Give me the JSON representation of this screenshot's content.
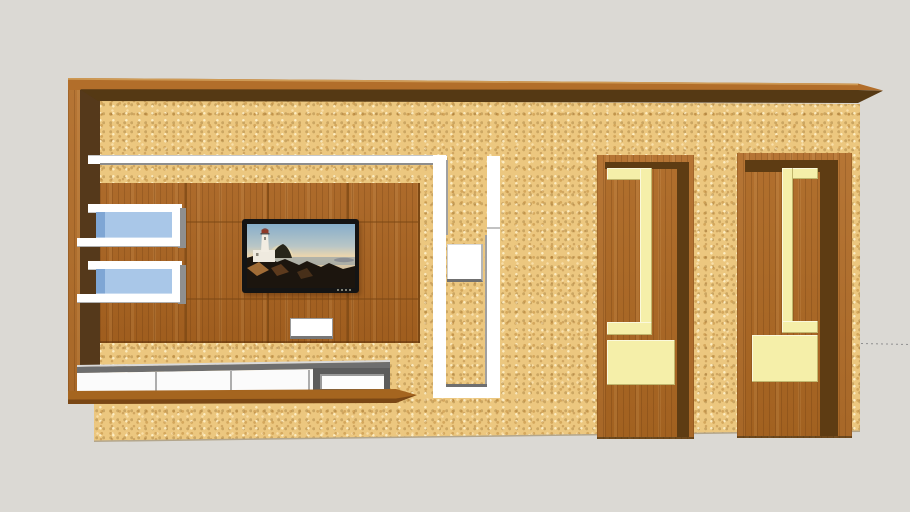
{
  "viewer": {
    "type": "3d-model-viewer",
    "canvas_width": 910,
    "canvas_height": 512
  },
  "colors": {
    "background": "#DBD9D4",
    "wall_tan": "#ECC77F",
    "beam_top": "#B26E2A",
    "beam_highlight": "#CE9A55",
    "beam_dark": "#553914",
    "frame_outer": "#B26E2A",
    "frame_inner_dark": "#55391B",
    "panel_wood": "#A96320",
    "panel_seam": "#7C4814",
    "shadow_gray": "#8D8D8D",
    "glass_blue": "#A9C7E8",
    "glass_blue_dark": "#7FA6D4",
    "console_top": "#6E6E6E",
    "console_frame": "#5C5C5C",
    "ledge_wood": "#A5651F",
    "door_wood": "#AC6722",
    "door_dark": "#5E3C13",
    "cream": "#F5EFA9",
    "tv_bezel": "#141414",
    "guide_line": "#8F8F8F",
    "floor_line": "#B3A68C"
  }
}
